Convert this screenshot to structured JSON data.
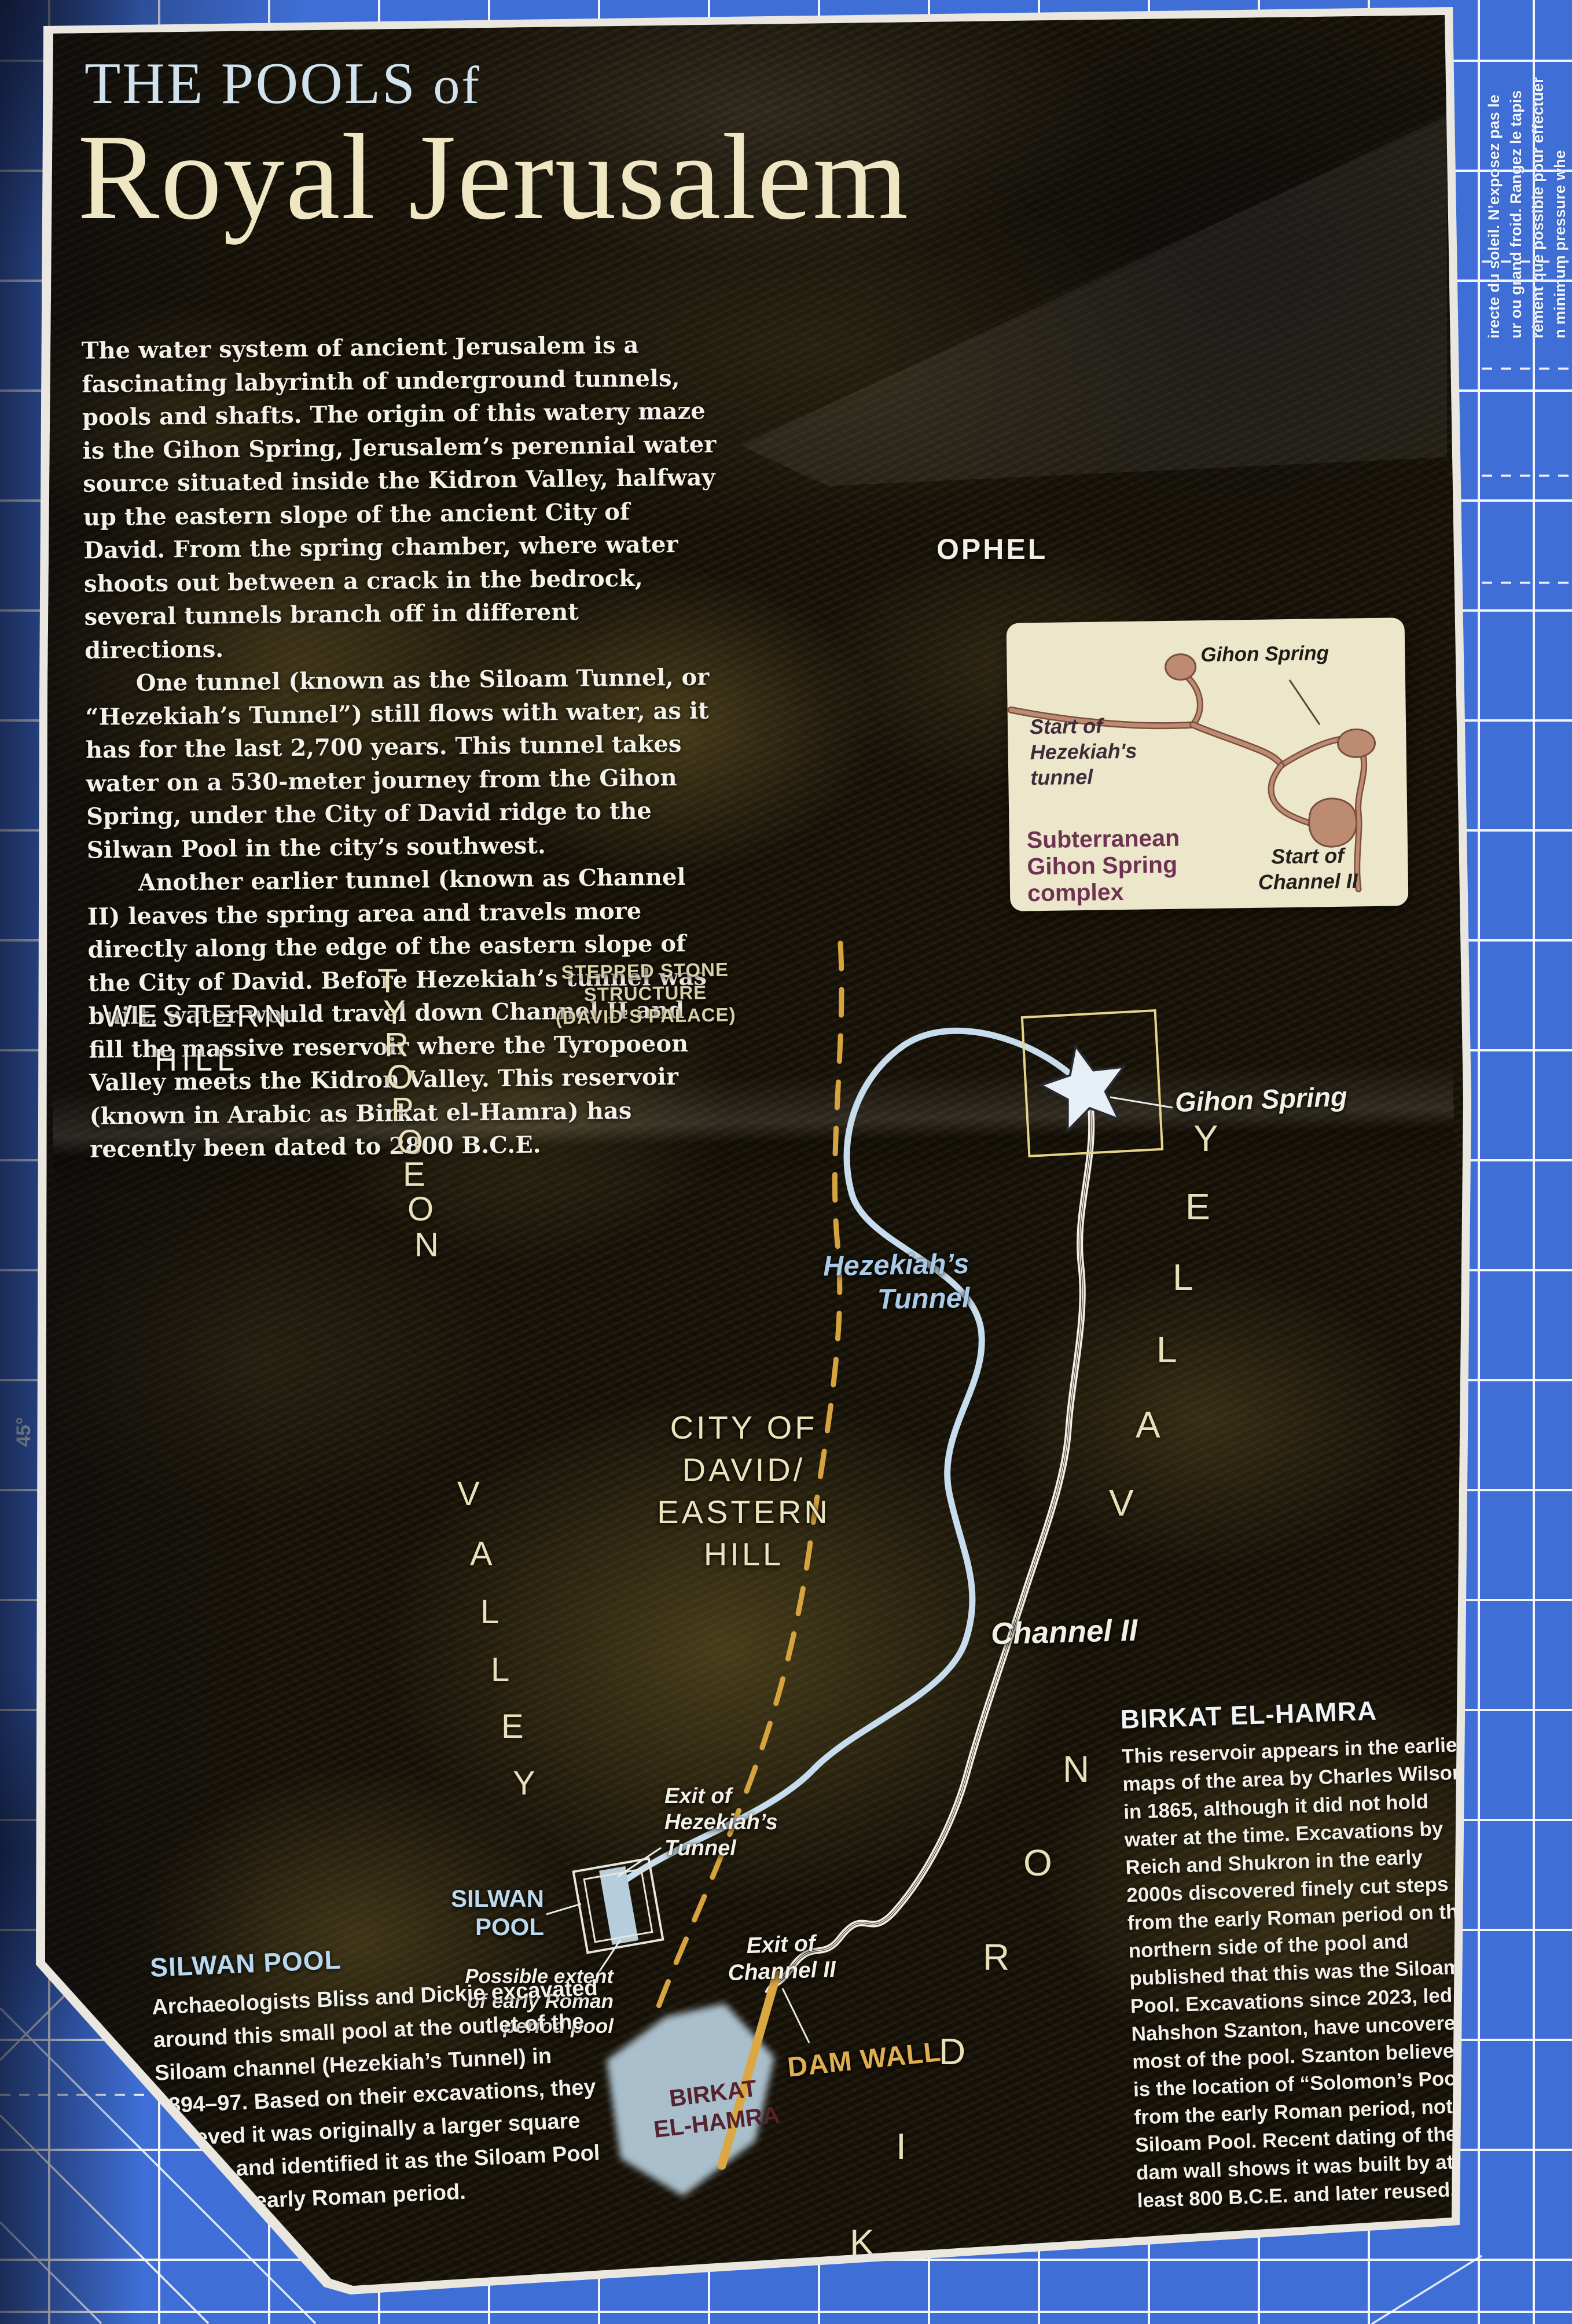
{
  "page": {
    "title_line1": "THE POOLS",
    "title_line1_small": "of",
    "title_line2": "Royal Jerusalem",
    "intro_p1": "The water system of ancient Jerusalem is a fascinating labyrinth of underground tunnels, pools and shafts. The origin of this watery maze is the Gihon Spring, Jerusalem’s perennial water source situated inside the Kidron Valley, halfway up the eastern slope of the ancient City of David. From the spring chamber, where water shoots out between a crack in the bedrock, several tunnels branch off in different directions.",
    "intro_p2": "One tunnel (known as the Siloam Tunnel, or “Hezekiah’s Tunnel”) still flows with water, as it has for the last 2,700 years. This tunnel takes water on a 530-meter journey from the Gihon Spring, under the City of David ridge to the Silwan Pool in the city’s southwest.",
    "intro_p3": "Another earlier tunnel (known as Channel II) leaves the spring area and travels more directly along the edge of the eastern slope of the City of David. Before Hezekiah’s tunnel was built, water would travel down Channel II and fill the massive reservoir where the Tyropoeon Valley meets the Kidron Valley. This reservoir (known in Arabic as Birkat el-Hamra) has recently been dated to 2800 B.C.E."
  },
  "map": {
    "ophel": "OPHEL",
    "western_hill": [
      "WESTERN",
      "HILL"
    ],
    "city_of_david": [
      "CITY OF",
      "DAVID/",
      "EASTERN",
      "HILL"
    ],
    "stepped_stone": [
      "STEPPED STONE",
      "STRUCTURE",
      "(DAVID’S PALACE)"
    ],
    "tyropoeon_valley": "TYROPOEON VALLEY",
    "kidron_valley": "KIDRON VALLEY",
    "gihon_spring": "Gihon Spring",
    "hezekiahs_tunnel": [
      "Hezekiah’s",
      "Tunnel"
    ],
    "channel_ii": "Channel II",
    "exit_hezekiah": [
      "Exit of",
      "Hezekiah’s",
      "Tunnel"
    ],
    "exit_channel_ii": [
      "Exit of",
      "Channel II"
    ],
    "possible_extent": [
      "Possible extent",
      "of early Roman",
      "period pool"
    ],
    "silwan_pool": [
      "SILWAN",
      "POOL"
    ],
    "birkat_el_hamra": [
      "BIRKAT",
      "EL-HAMRA"
    ],
    "dam_wall": "DAM WALL"
  },
  "inset": {
    "gihon_spring": "Gihon Spring",
    "start_hezekiah": [
      "Start of",
      "Hezekiah's",
      "tunnel"
    ],
    "heading": [
      "Subterranean",
      "Gihon Spring",
      "complex"
    ],
    "start_channel_ii": [
      "Start of",
      "Channel II"
    ]
  },
  "sidebars": {
    "silwan": {
      "heading": "SILWAN POOL",
      "body": "Archaeologists Bliss and Dickie excavated around this small pool at the outlet of the Siloam channel (Hezekiah’s Tunnel) in 1894–97. Based on their excavations, they believed it was originally a larger square design and identified it as the Siloam Pool from the early Roman period."
    },
    "birkat": {
      "heading": "BIRKAT EL-HAMRA",
      "body": "This reservoir appears in the earliest maps of the area by Charles Wilson in 1865, although it did not hold water at the time. Excavations by Reich and Shukron in the early 2000s discovered finely cut steps from the early Roman period on the northern side of the pool and published that this was the Siloam Pool. Excavations since 2023, led by Nahshon Szanton, have uncovered most of the pool. Szanton believes it is the location of “Solomon’s Pool” from the early Roman period, not the Siloam Pool. Recent dating of the dam wall shows it was built by at least 800 B.C.E. and later reused."
    }
  },
  "mat": {
    "angle_label": "45°",
    "edge_lines": [
      "irecte du soleil. N’exposez pas le",
      "ur ou grand froid. Rangez le tapis",
      "rément que possible pour effectuer",
      "n minimum pressure whe"
    ]
  },
  "colors": {
    "mat_blue": "#3f6fd6",
    "tunnel_blue": "#c7dcec",
    "wall_dash_gold": "#d7a33f",
    "dam_gold": "#d9a843",
    "pool_blue": "#b6cddc",
    "birkat_maroon": "#55222e",
    "inset_card": "#ece6cb",
    "title_blue": "#cfe2ee",
    "title_cream": "#efe7c3"
  }
}
